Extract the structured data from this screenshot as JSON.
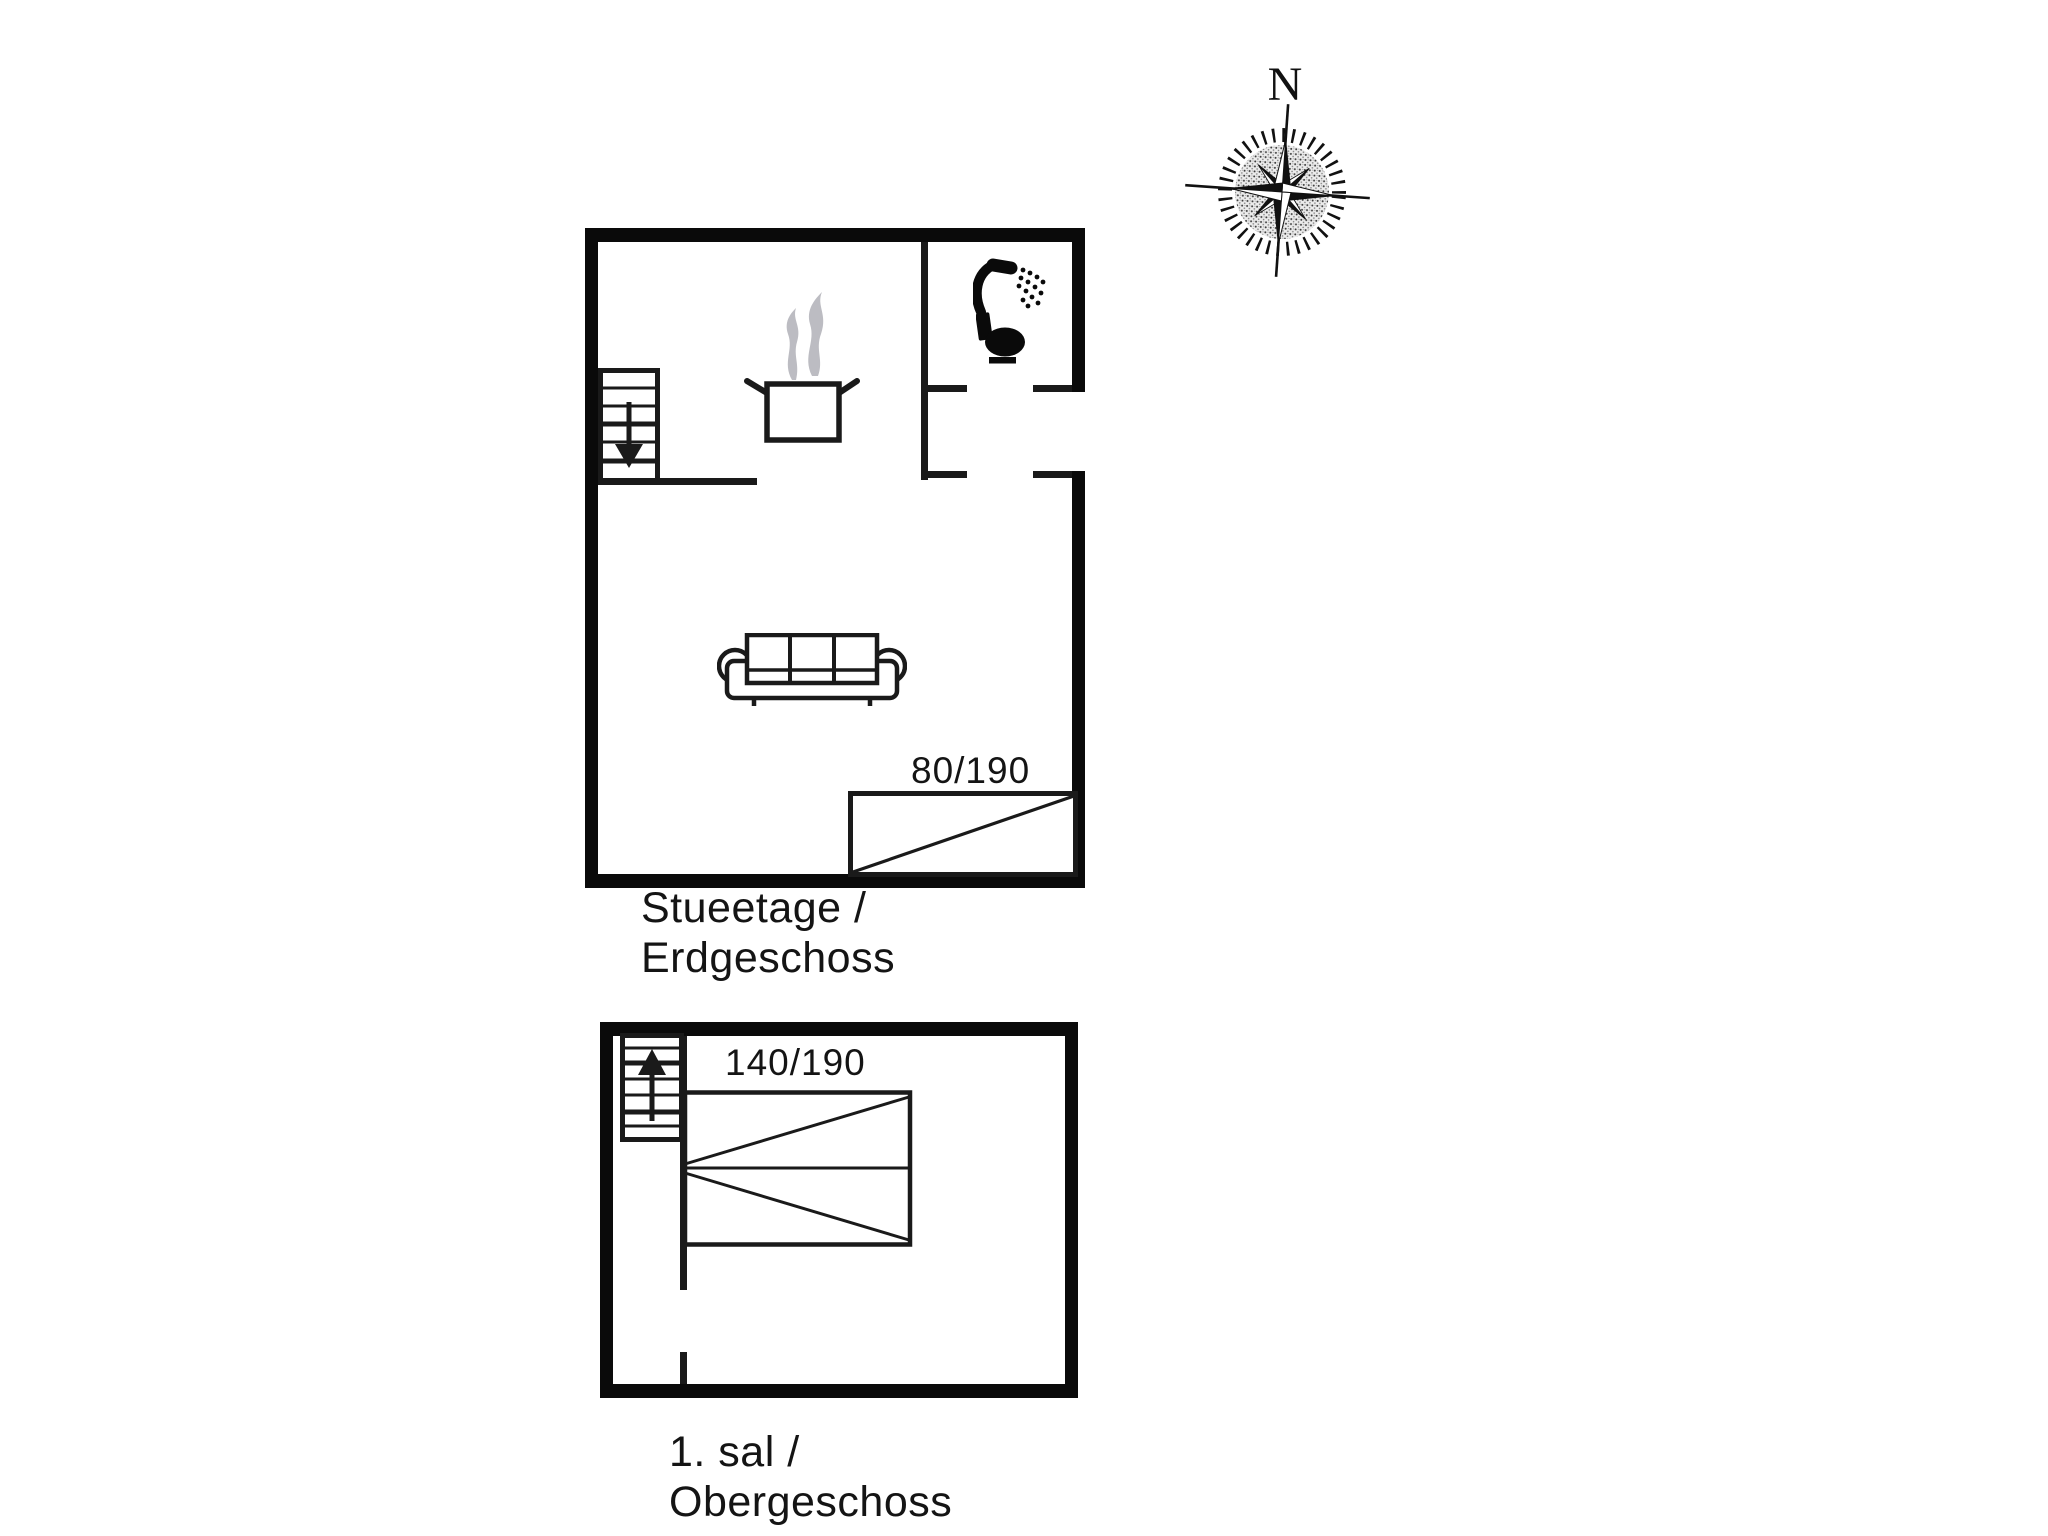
{
  "document": {
    "kind": "holiday-house floor plan drawing",
    "background": "#ffffff"
  },
  "compass": {
    "north_label": "N",
    "icon": "compass-rose-icon"
  },
  "ground_floor": {
    "title": "Stueetage /\nErdgeschoss",
    "bed_size_label": "80/190",
    "icons": [
      "stairs-down-icon",
      "cooking-pot-icon",
      "steam-icon",
      "shower-icon",
      "toilet-icon",
      "sofa-icon",
      "single-bed-icon"
    ]
  },
  "upper_floor": {
    "title": "1. sal /\nObergeschoss",
    "bed_size_label": "140/190",
    "icons": [
      "stairs-up-icon",
      "double-bed-icon"
    ]
  },
  "colors": {
    "wall": "#0a0a0a",
    "line": "#1a1a1a",
    "steam": "#bcbcc2",
    "background": "#ffffff"
  }
}
